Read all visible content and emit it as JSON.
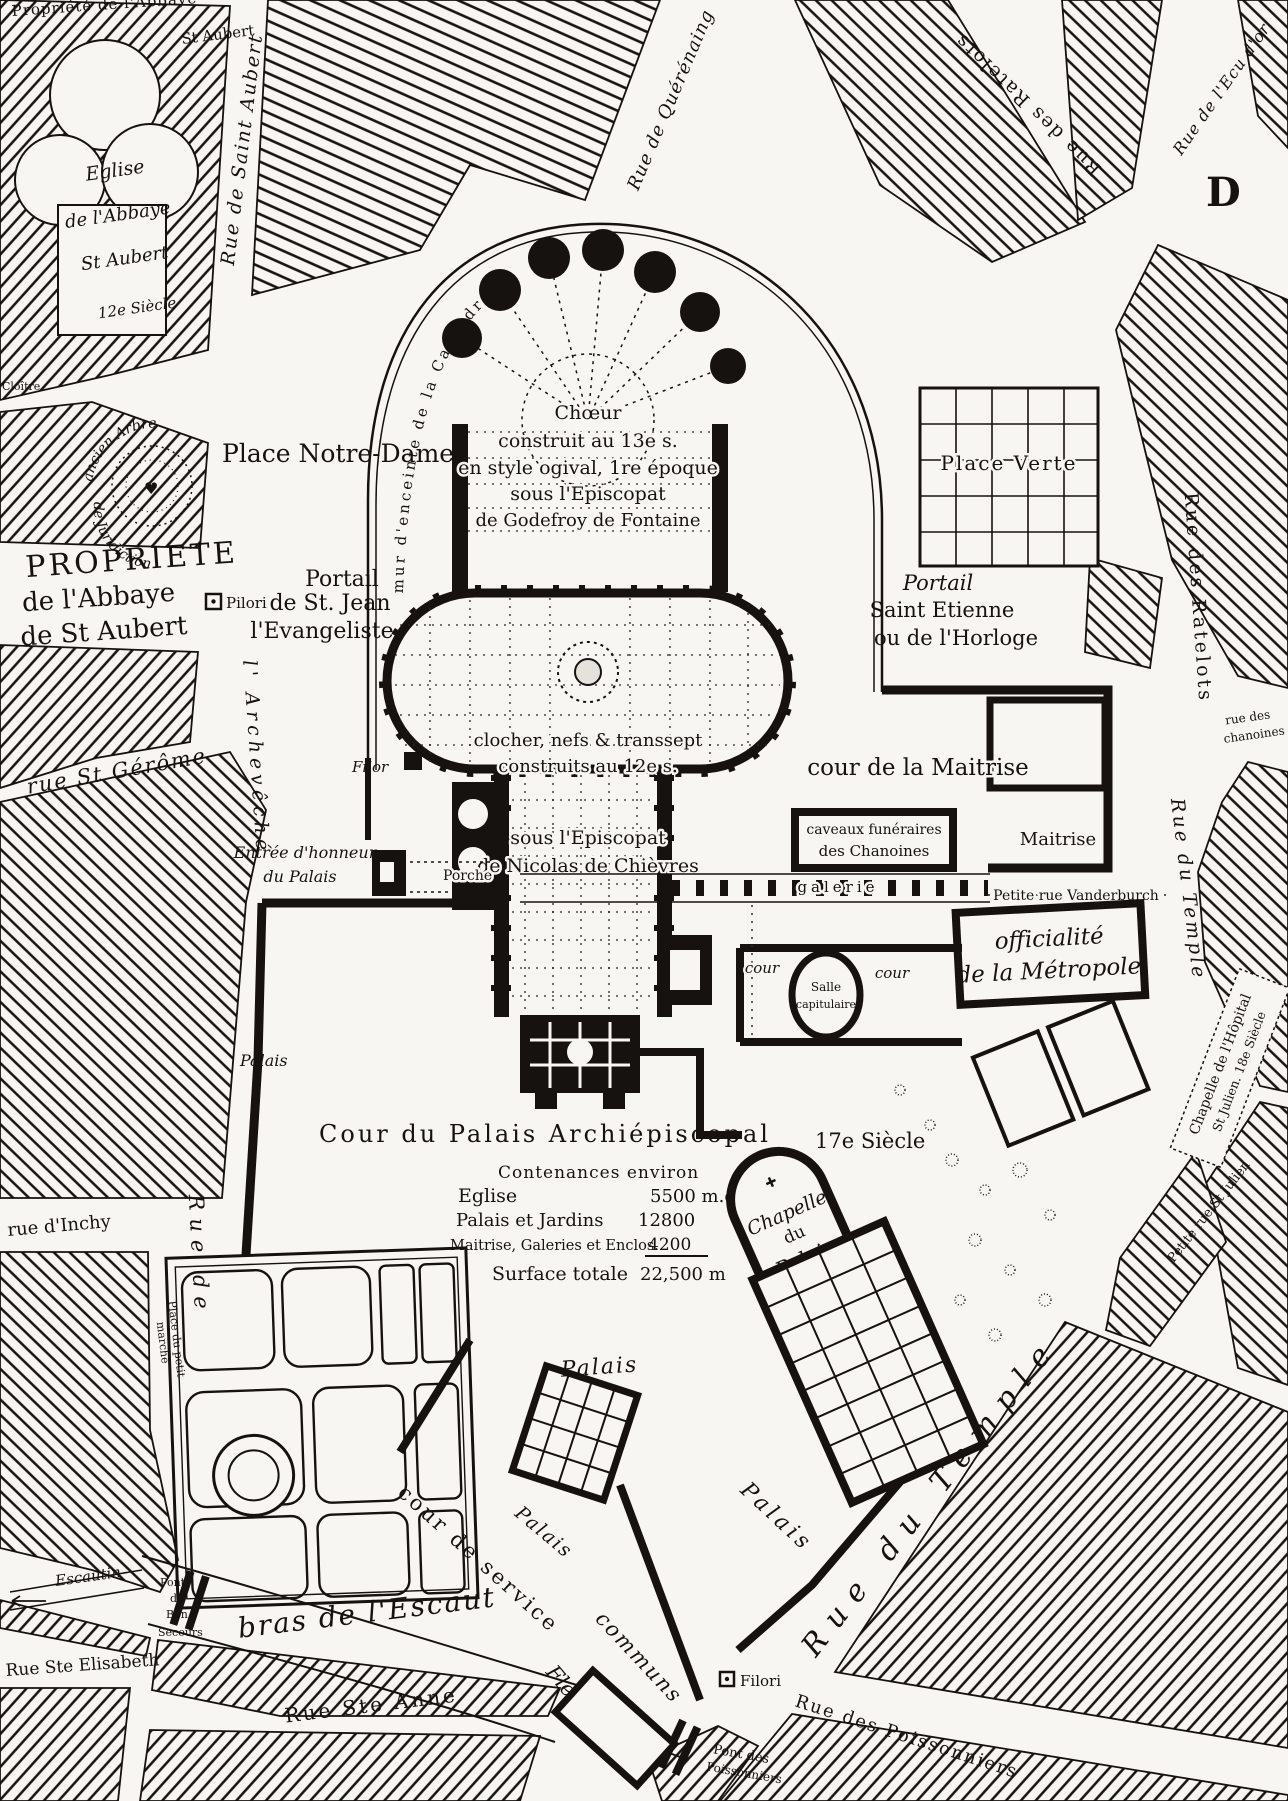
{
  "abbey": {
    "propriete_line1": "Propriété de l'Abbaye",
    "propriete_line2": "St Aubert",
    "eglise": [
      "Eglise",
      "de l'Abbaye",
      "St Aubert",
      "12e Siècle"
    ],
    "cloitre": "Cloître"
  },
  "streets": {
    "rue_st_aubert": "Rue de Saint Aubert",
    "rue_querenaing": "Rue de Quérénaing",
    "rue_ratelots_top": "Rue des Ratelots",
    "rue_ratelots_right": "Rue des Ratelots",
    "rue_ecu_dor": "Rue de l'Ecu d'or",
    "rue_st_gerome": "rue St Gérôme",
    "rue_archeveche_part1": "Rue de",
    "rue_archeveche_part2": "l' Archevêché",
    "rue_inchy": "rue d'Inchy",
    "place_petit_marche_1": "Place du petit",
    "place_petit_marche_2": "marché",
    "petite_rue_vanderburch": "Petite rue Vanderburch",
    "rue_des_chanoines_1": "rue des",
    "rue_des_chanoines_2": "chanoines",
    "rue_du_temple_upper": "Rue du Temple",
    "rue_du_temple_lower": "Rue du Temple",
    "petite_rue_st_julien": "Petite rue St Julien",
    "rue_ste_anne": "Rue Ste Anne",
    "rue_ste_elisabeth": "Rue Ste Elisabeth",
    "rue_poissonniers": "Rue des Poissonniers"
  },
  "squares": {
    "place_notre_dame": "Place Notre-Dame",
    "place_verte": "Place Verte"
  },
  "property": [
    "PROPRIETE",
    "de l'Abbaye",
    "de St Aubert"
  ],
  "tree": {
    "arc1": "ancien Arbre",
    "arc2": "de Juridiction"
  },
  "enceinte": "mur d'enceinte de la Cathédrale",
  "marker_d": "D",
  "cathedral": {
    "choir": [
      "Chœur",
      "construit au 13e s.",
      "en style ogival, 1re époque",
      "sous l'Episcopat",
      "de Godefroy de Fontaine"
    ],
    "nave": [
      "clocher, nefs & transsept",
      "construits au 12e s.",
      "sous l'Episcopat",
      "de Nicolas de Chièvres"
    ],
    "portal_west": [
      "Portail",
      "de St. Jean",
      "l'Evangeliste"
    ],
    "pilori_west": "Pilori",
    "portal_east": [
      "Portail",
      "Saint Etienne",
      "ou de l'Horloge"
    ],
    "filor": "Filor",
    "pilori_south": "Filori"
  },
  "maitrise": {
    "cour": "cour de la Maitrise",
    "name": "Maitrise",
    "caveaux": [
      "caveaux funéraires",
      "des Chanoines"
    ],
    "galerie": "galerie"
  },
  "officialite": [
    "officialité",
    "de la Métropole"
  ],
  "chapter": {
    "cour_left": "cour",
    "cour_right": "cour",
    "salle": [
      "Salle",
      "capitulaire"
    ]
  },
  "palace": {
    "entree": [
      "Entrée d'honneur",
      "du Palais"
    ],
    "porche": "Porche",
    "cour_palais": "Cour du Palais Archiépiscopal",
    "siecle": "17e Siècle",
    "palais_left": "Palais",
    "palais_center": "Palais",
    "palais_south1": "Palais",
    "palais_south2": "Palais",
    "chapelle": [
      "Chapelle",
      "du",
      "Palais"
    ],
    "cour_service": "cour de service",
    "communs": "communs"
  },
  "contenances": {
    "title": "Contenances environ",
    "rows": [
      {
        "label": "Eglise",
        "value": "5500 m.c."
      },
      {
        "label": "Palais et Jardins",
        "value": "12800"
      },
      {
        "label": "Maitrise, Galeries et Enclos.",
        "value": "4200"
      }
    ],
    "total_label": "Surface totale",
    "total_value": "22,500 m"
  },
  "hopital": {
    "chapelle_1": "Chapelle de l'Hôpital",
    "chapelle_2": "St Julien.  18e Siècle"
  },
  "river": {
    "escautin": "Escautin",
    "bras": "bras de l'Escaut",
    "fleuve": "Fleuve",
    "pont_bon_secours": [
      "Pont",
      "de",
      "Bon",
      "Secours"
    ],
    "pont_poissonniers": [
      "Pont des",
      "Poissonniers"
    ]
  }
}
